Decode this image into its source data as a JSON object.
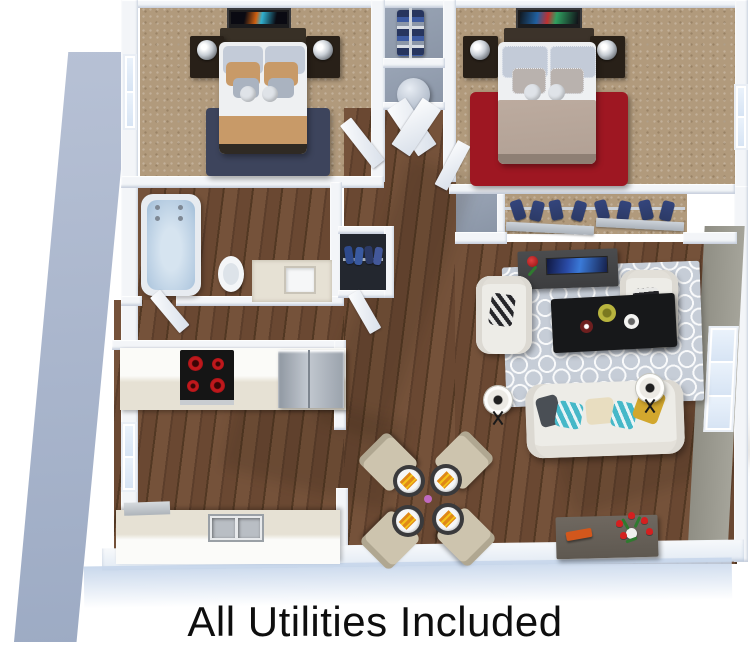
{
  "caption": "All Utilities Included",
  "colors": {
    "page_bg": "#ffffff",
    "wall_white": "#f3f5f8",
    "wall_gray_light": "#a5a49a",
    "wall_gray_dark": "#8f8e84",
    "exterior_strip_light": "#b7c1d5",
    "exterior_strip_dark": "#9dabc4",
    "bottom_glow": "#c9d8ec",
    "carpet": "#b19a7c",
    "wood_light": "#75523a",
    "wood_dark": "#5c3e2b",
    "rug_navy": "#3d445c",
    "rug_red": "#9e1722",
    "rug_living": "#c6cdd7",
    "bed_tan": "#c89a68",
    "bed_taupe": "#b2a195",
    "pillow_blue": "#c3cbd8",
    "headboard_brown": "#383026",
    "nightstand_dark": "#282018",
    "tub_blue": "#b7cde2",
    "stove_black": "#151515",
    "stove_red": "#c0181c",
    "clothes_navy": "#2c3a66",
    "sofa_white": "#edece7",
    "accent_teal": "#46b8c8",
    "accent_mustard": "#d2a72e",
    "coffee_table_black": "#17181a",
    "console_gray": "#4b4c4e",
    "console_wood": "#6f6860",
    "tray_orange": "#d2571c",
    "tulip_red": "#d42020",
    "leaf_green": "#2f7a2f",
    "counter_cream": "#e6e1d4",
    "fridge_gray": "#9aa2ac",
    "chair_beige": "#cdc4ae",
    "napkin_orange": "#e08818",
    "caption_color": "#0e0e0e"
  }
}
